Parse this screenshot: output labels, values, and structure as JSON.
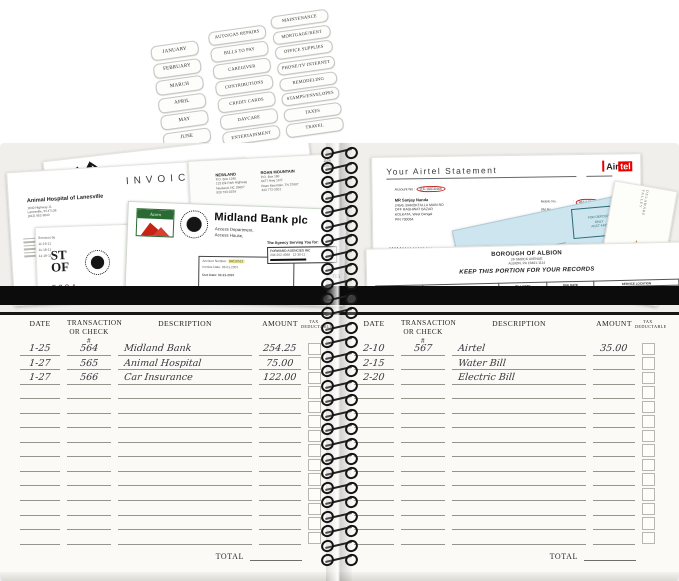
{
  "labels_sheet": {
    "months": [
      "JANUARY",
      "FEBRUARY",
      "MARCH",
      "APRIL",
      "MAY",
      "JUNE"
    ],
    "categories_col2": [
      "AUTO/GAS REPAIRS",
      "BILLS TO PAY",
      "CAREGIVER",
      "CONTRIBUTIONS",
      "CREDIT CARDS",
      "DAYCARE",
      "ENTERTAINMENT"
    ],
    "categories_col3": [
      "MAINTENANCE",
      "MORTGAGE/RENT",
      "OFFICE SUPPLIES",
      "PHONE/TV INTERNET",
      "REMODELING",
      "STAMPS/ENVELOPES",
      "TAXES",
      "TRAVEL"
    ]
  },
  "left_pocket": {
    "invoice": {
      "title": "INVOICE",
      "company": "Animal Hospital of Lanesville",
      "addr1": "1840 Highway 11",
      "addr2": "Lanesville, IN 47136",
      "phone": "(812) 952-3643",
      "tagline": "“Love your pets, keep them healthy”",
      "meta": "Amount:   11-16-11  #  2-124"
    },
    "utility_bill": {
      "num1": "1126",
      "num2": "1063",
      "office_a": [
        "NEWLAND",
        "P.O. Box 1240",
        "123 Elk Park Highway",
        "Newland, NC 28657",
        "828 733-0159"
      ],
      "office_b": [
        "ROAN MOUNTAIN",
        "P.O. Box 160",
        "8477 Hwy 19 E",
        "Roan Mountain, TN 37687",
        "423 772-3201"
      ],
      "table_headers": [
        "LOCATION",
        "METER NUMBER"
      ],
      "table_row": [
        "DRAFT RD 2702",
        "1260000"
      ]
    },
    "bank_statement": {
      "logo_text": "Acorn",
      "name": "Midland Bank plc",
      "dept": "Access Department,",
      "house": "Access House,",
      "account_label": "Account Number:",
      "account_number": "84010513",
      "invoice_date": "Invoice Date: 03-01-2007",
      "due_date": "Due Date: 03-21-2007",
      "agency_tag": "The Agency Serving You for:",
      "agency_name": "FORWARD AGENCIES INC",
      "agency_phone": "234-262-4098",
      "agency_date": "12-30-11",
      "footer": "Final Billing Statement",
      "partial_number": "785"
    },
    "state_doc": {
      "big1": "ST",
      "big2": "OF",
      "number": "5224",
      "service_lines": [
        "Services by",
        "11-16-11",
        "11-16-11",
        "11-16-11"
      ]
    }
  },
  "right_pocket": {
    "airtel": {
      "title": "Your  Airtel  Statement",
      "logo_air": "Air",
      "logo_tel": "tel",
      "account": "Account No :",
      "account_number": "116-10010466",
      "customer": [
        "MR Sanjay Nanda",
        "245/6, BAROKTALLA MAIN RD",
        "OFF RAGHWAT BAZAR",
        "KOLKATA, West Bengal",
        "PIN 700054"
      ],
      "meta": [
        {
          "label": "Mobile No.",
          "value": "9831175506",
          "circled": true
        },
        {
          "label": "SM No.",
          "value": "1417705596",
          "circled": false
        },
        {
          "label": "Bill Date",
          "value": "12/02/04",
          "circled": false
        },
        {
          "label": "Due Date",
          "value": "17/02/04",
          "circled": true
        },
        {
          "label": "Bill Period",
          "value": "21/04 - 10/02/04",
          "circled": false
        }
      ],
      "footer_cells": [
        "Previous Statement",
        "Payments"
      ],
      "amount_due_label": "Amount Due",
      "amount_due_sub": "(Rs.)",
      "amount_due_value": "5.45"
    },
    "deposit_check": {
      "stamp_lines": [
        "FOR DEPOSIT",
        "ONLY",
        "ACCT 4431"
      ]
    },
    "insurance_card": {
      "line1": "DELAWARE VALLEY",
      "line2": "INSURANCE CO",
      "icon": "caduceus"
    },
    "borough_bill": {
      "name": "BOROUGH OF ALBION",
      "addr1": "26 SMOCK AVENUE",
      "addr2": "ALBION, PA 16401-1114",
      "keep": "KEEP THIS PORTION FOR YOUR RECORDS",
      "table_headers": [
        "ACCOUNT",
        "BILLING PERIOD",
        "BILL DATE",
        "DUE DATE",
        "SERVICE LOCATION"
      ],
      "table_row": [
        "123-0",
        "03/13/12 - 06/13/12",
        "06/13/12",
        "07/03/12",
        "26 SMOCK AVENUE"
      ]
    }
  },
  "ledger": {
    "headers": {
      "date": "DATE",
      "check1": "TRANSACTION",
      "check2": "OR CHECK #",
      "description": "DESCRIPTION",
      "amount": "AMOUNT",
      "tax1": "TAX",
      "tax2": "DEDUCTABLE"
    },
    "total_label": "TOTAL",
    "blank_rows": 11,
    "left_page": {
      "rows": [
        {
          "date": "1-25",
          "check": "564",
          "description": "Midland Bank",
          "amount": "254.25"
        },
        {
          "date": "1-27",
          "check": "565",
          "description": "Animal Hospital",
          "amount": "75.00"
        },
        {
          "date": "1-27",
          "check": "566",
          "description": "Car Insurance",
          "amount": "122.00"
        }
      ]
    },
    "right_page": {
      "rows": [
        {
          "date": "2-10",
          "check": "567",
          "description": "Airtel",
          "amount": "35.00"
        },
        {
          "date": "2-15",
          "check": "",
          "description": "Water Bill",
          "amount": ""
        },
        {
          "date": "2-20",
          "check": "",
          "description": "Electric Bill",
          "amount": ""
        }
      ]
    }
  }
}
